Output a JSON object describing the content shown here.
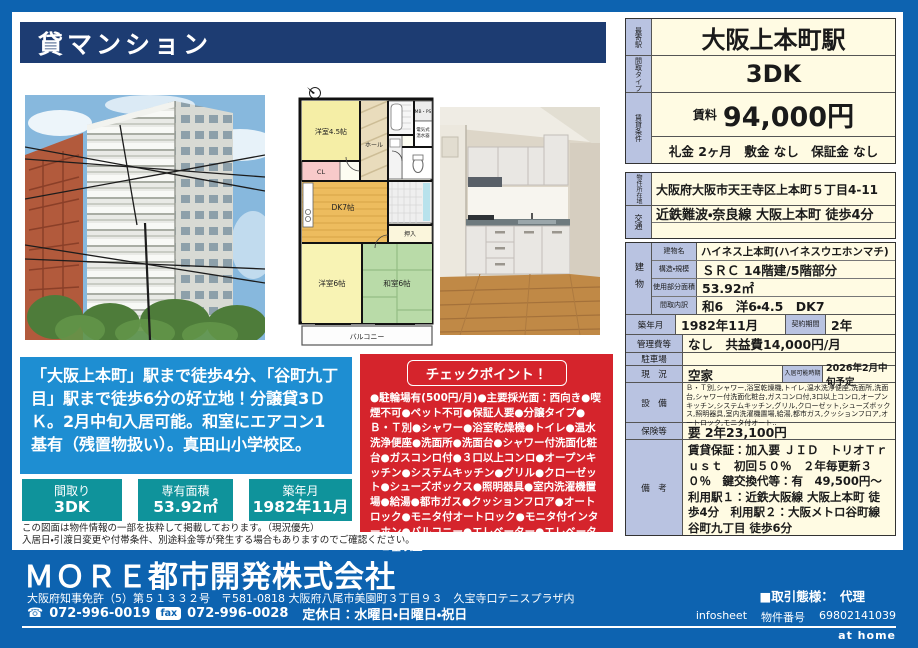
{
  "header": {
    "title": "貸マンション"
  },
  "offer": {
    "station_label": "最寄駅",
    "station": "大阪上本町駅",
    "type_label": "間取タイプ",
    "type": "3DK",
    "cond_label": "賃貸条件",
    "rent_label": "賃料",
    "rent": "94,000円",
    "fees": "礼金 2ヶ月　敷金 なし　保証金 なし"
  },
  "details": {
    "location_label": "物件所在地",
    "location": "大阪府大阪市天王寺区上本町５丁目4-11",
    "transport_label": "交通",
    "transport": "近鉄難波・奈良線 大阪上本町 徒歩4分",
    "building_label": "建物",
    "bname_label": "建物名",
    "bname": "ハイネス上本町(ハイネスウエホンマチ)",
    "structure_label": "構造・規模",
    "structure": "ＳＲＣ 14階建/5階部分",
    "area_label": "使用部分面積",
    "area": "53.92㎡",
    "rooms_label": "間取内訳",
    "rooms": "和6　洋6・4.5　DK7",
    "built_label": "築年月",
    "built": "1982年11月",
    "contract_label": "契約期間",
    "contract": "2年",
    "mgmt_label": "管理費等",
    "mgmt": "なし　共益費14,000円/月",
    "parking_label": "駐車場",
    "parking": "",
    "status_label": "現　況",
    "status": "空家",
    "movein_label": "入居可能時期",
    "movein": "2026年2月中旬予定",
    "equip_label": "設　備",
    "equip": "Ｂ・Ｔ別,シャワー,浴室乾燥機,トイレ,温水洗浄便座,洗面所,洗面台,シャワー付洗面化粧台,ガスコンロ付,3口以上コンロ,オープンキッチン,システムキッチン,グリル,クローゼット,シューズボックス,照明器具,室内洗濯機置場,給湯,都市ガス,クッションフロア,オートロック,モニタ付オート..",
    "insurance_label": "保険等",
    "insurance": "要 2年23,100円",
    "remarks_label": "備　考",
    "remarks": "賃貸保証：加入要 ＪＩＤ　トリオＴｒｕｓｔ　初回５０％　２年毎更新３０％　鍵交換代等：有　49,500円～　利用駅１：近鉄大阪線 大阪上本町 徒歩4分　利用駅２：大阪メトロ谷町線 谷町九丁目 徒歩6分"
  },
  "floorplan": {
    "room_west45": "洋室4.5帖",
    "closet": "CL",
    "hall": "ホール",
    "mbps": "MB・PS",
    "heater_line1": "電気式",
    "heater_line2": "温水器",
    "dk": "DK7帖",
    "oshiire": "押入",
    "room_west6": "洋室6帖",
    "room_japanese6": "和室6帖",
    "balcony": "バルコニー"
  },
  "promo": {
    "text": "「大阪上本町」駅まで徒歩4分、「谷町九丁目」駅まで徒歩6分の好立地！分譲貸3ＤＫ。2月中旬入居可能。和室にエアコン1基有（残置物扱い）。真田山小学校区。"
  },
  "checkpoint": {
    "title": "チェックポイント！",
    "body": "●駐輪場有(500円/月)●主要採光面：西向き●喫煙不可●ペット不可●保証人要●分譲タイプ●Ｂ・Ｔ別●シャワー●浴室乾燥機●トイレ●温水洗浄便座●洗面所●洗面台●シャワー付洗面化粧台●ガスコンロ付●３口以上コンロ●オープンキッチン●システムキッチン●グリル●クローゼット●シューズボックス●照明器具●室内洗濯機置場●給湯●都市ガス●クッションフロア●オートロック●モニタ付オートロック●モニタ付インターホン●バルコニー●エレベーター●エレベーター２基以上"
  },
  "summary": [
    {
      "label": "間取り",
      "value": "3DK"
    },
    {
      "label": "専有面積",
      "value": "53.92㎡"
    },
    {
      "label": "築年月",
      "value": "1982年11月"
    }
  ],
  "disclaimer": {
    "line1": "この図面は物件情報の一部を抜粋して掲載しております。（現況優先）",
    "line2": "入居日・引渡日変更や付帯条件、別途料金等が発生する場合もありますのでご確認ください。"
  },
  "footer": {
    "company": "ＭＯＲＥ都市開発株式会社",
    "license": "大阪府知事免許（5）第５１３３２号　〒581-0818 大阪府八尾市美園町３丁目９３　久宝寺口テニスプラザ内",
    "tel": "072-996-0019",
    "fax_label": "fax",
    "fax": "072-996-0028",
    "holidays": "定休日：水曜日・日曜日・祝日",
    "deal": "■取引態様：　代理",
    "infosheet": "infosheet",
    "pno_label": "物件番号",
    "pno": "69802141039",
    "athome": "at home"
  },
  "colors": {
    "frame_blue": "#0d63b0",
    "navy_header": "#1d3c72",
    "promo_blue": "#1e8ed2",
    "checkpoint_red": "#d5242c",
    "summary_teal": "#0f939b",
    "label_cell": "#b9c3e1",
    "value_cell": "#fffbe3"
  }
}
